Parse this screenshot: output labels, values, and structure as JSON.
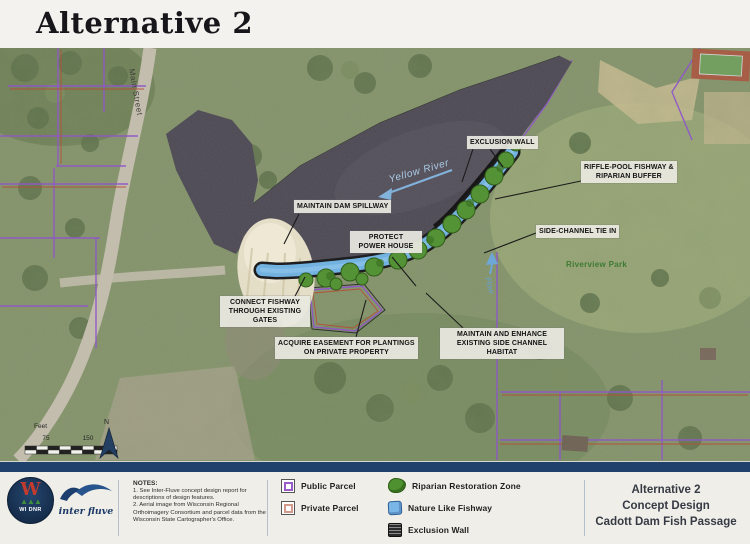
{
  "page_title": "Alternative 2",
  "map": {
    "callouts": {
      "exclusion_wall": [
        "EXCLUSION WALL"
      ],
      "riffle_pool": [
        "RIFFLE-POOL FISHWAY &",
        "RIPARIAN BUFFER"
      ],
      "side_channel": [
        "SIDE-CHANNEL TIE IN"
      ],
      "maintain_dam": [
        "MAINTAIN DAM SPILLWAY"
      ],
      "protect_power": [
        "PROTECT",
        "POWER HOUSE"
      ],
      "connect_fishway": [
        "CONNECT FISHWAY",
        "THROUGH EXISTING",
        "GATES"
      ],
      "acquire_easement": [
        "ACQUIRE EASEMENT FOR PLANTINGS",
        "ON PRIVATE PROPERTY"
      ],
      "maintain_enhance": [
        "MAINTAIN AND ENHANCE",
        "EXISTING SIDE CHANNEL",
        "HABITAT"
      ]
    },
    "labels": {
      "yellow_river": "Yellow River",
      "flow": "Flow",
      "main_street": "Main Street",
      "riverview_park": "Riverview Park"
    },
    "scale": {
      "unit": "Feet",
      "mid": "75",
      "end": "150",
      "north": "N"
    }
  },
  "footer": {
    "logos": {
      "dnr": "WI DNR",
      "interfluve": "inter fluve"
    },
    "notes": {
      "heading": "NOTES:",
      "items": [
        "1. See Inter-Fluve concept design report for descriptions of design features.",
        "2. Aerial image from Wisconsin Regional Orthoimagery Consortium and parcel data from the Wisconsin State Cartographer's Office."
      ]
    },
    "legend": {
      "public": "Public Parcel",
      "private": "Private Parcel",
      "riparian": "Riparian Restoration Zone",
      "fishway": "Nature Like Fishway",
      "exclusion": "Exclusion Wall"
    },
    "title_block": [
      "Alternative 2",
      "Concept Design",
      "Cadott Dam Fish Passage"
    ]
  },
  "colors": {
    "navy_bar": "#20416b",
    "fishway_blue": "#6fb2e2",
    "riparian_green": "#4f9030",
    "parcel_purple": "#8c52c8",
    "parcel_red": "#b5472e",
    "pond_water": "#4e4a55"
  }
}
